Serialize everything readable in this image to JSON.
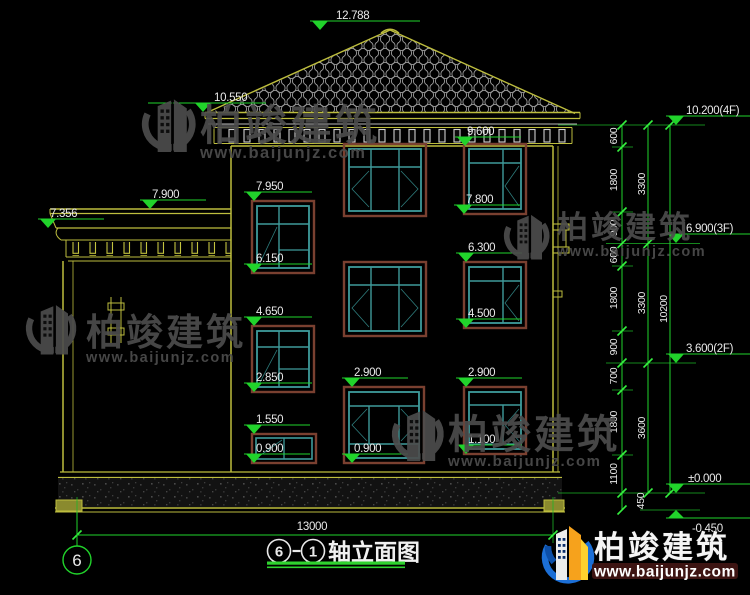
{
  "drawing": {
    "title": {
      "axis_start": "6",
      "axis_end": "1",
      "name": "轴立面图"
    },
    "bottom_dim": "13000",
    "grid_bubble": "6"
  },
  "markers": {
    "ridge": "12.788",
    "eave_left": "10.550",
    "porch_top": "7.900",
    "porch_soffit": "7.356",
    "eave_right": "9.600",
    "w1l_head": "7.950",
    "w1l_sill": "6.150",
    "w1r_sill": "7.800",
    "w2r_head": "6.300",
    "w2l_head": "4.650",
    "w2r_sill": "4.500",
    "w2l_sill": "2.850",
    "w3m_head": "2.900",
    "w3r_head": "2.900",
    "w3l_head": "1.550",
    "w3l_sill": "0.900",
    "w3m_sill": "0.900",
    "w3r_sill": "1.100",
    "floor4": "10.200(4F)",
    "floor3": "6.900(3F)",
    "floor2": "3.600(2F)",
    "ground": "±0.000",
    "below_grade": "-0.450"
  },
  "dims": {
    "chain_inner": [
      "600",
      "1800",
      "900",
      "600",
      "1800",
      "900",
      "700",
      "1800",
      "1100",
      "450"
    ],
    "chain_mid": [
      "3300",
      "3300",
      "3600"
    ],
    "chain_outer": [
      "10200"
    ]
  },
  "watermark": {
    "brand": "柏竣建筑",
    "url": "www.baijunjz.com"
  },
  "logo": {
    "brand": "柏竣建筑",
    "url": "www.baijunjz.com"
  },
  "colors": {
    "background": "#000000",
    "wall_yellow": "#bdbd3e",
    "dim_green": "#21d32b",
    "window_teal": "#3f9b9b",
    "frame_brown": "#7a4030",
    "tile_gray": "#9c9c9c",
    "text_white": "#e9e9e9",
    "watermark_gray": "#4d4d4d",
    "logo_blue": "#1c6fd6",
    "logo_orange": "#f6a21c"
  }
}
